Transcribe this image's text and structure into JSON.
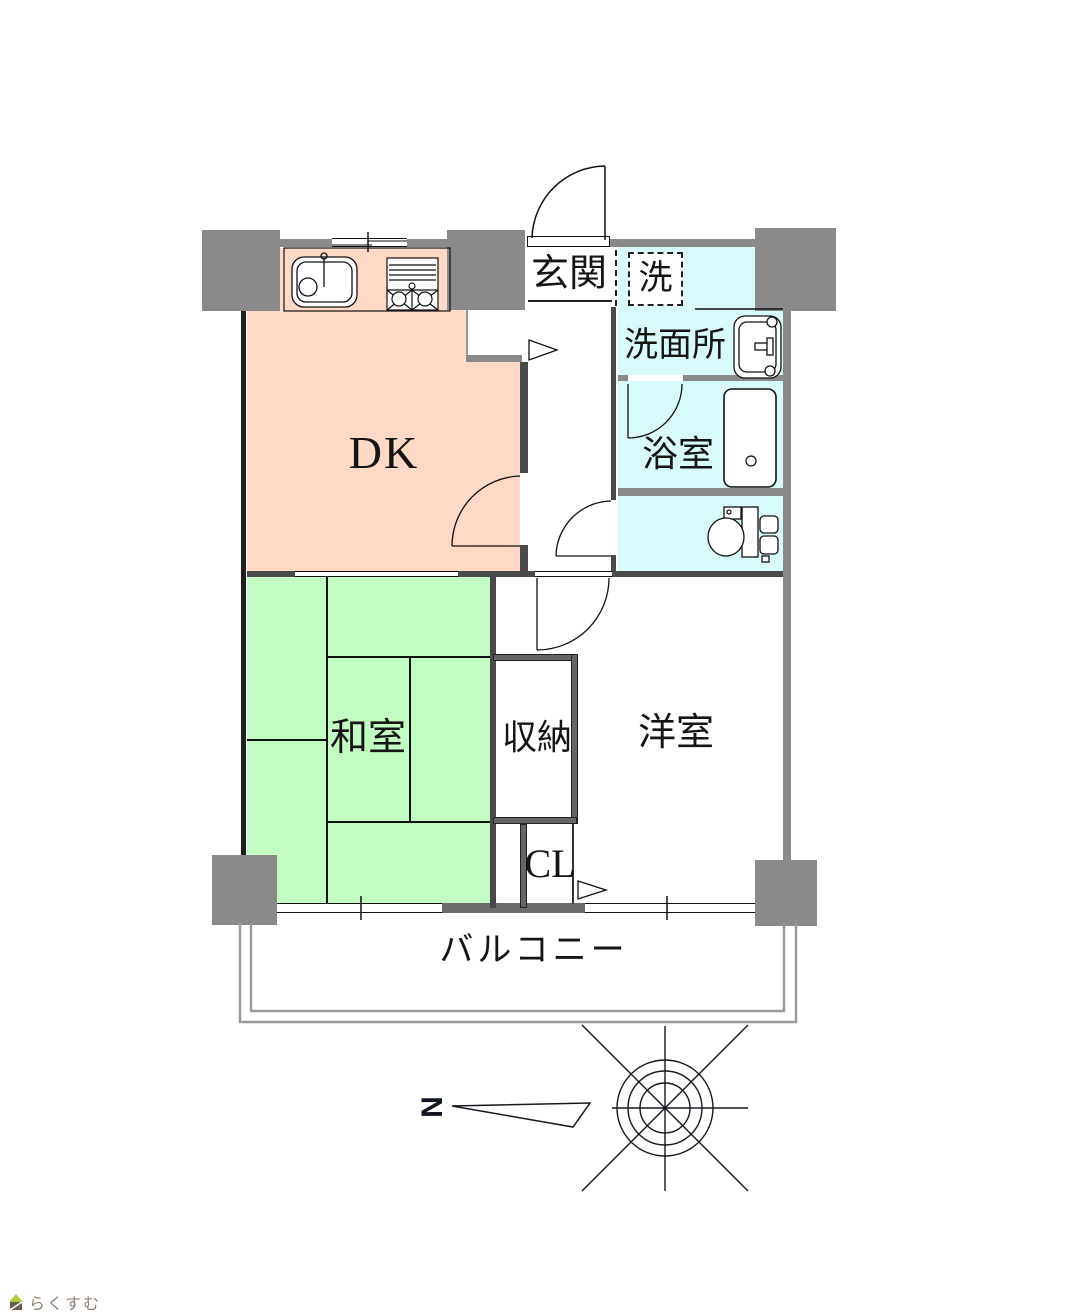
{
  "rooms": {
    "dk": {
      "label": "DK"
    },
    "genkan": {
      "label": "玄関"
    },
    "laundry": {
      "label": "洗"
    },
    "washroom": {
      "label": "洗面所"
    },
    "bathroom": {
      "label": "浴室"
    },
    "japanese_room": {
      "label": "和室"
    },
    "storage": {
      "label": "収納"
    },
    "western_room": {
      "label": "洋室"
    },
    "closet": {
      "label": "CL"
    },
    "balcony": {
      "label": "バルコニー"
    }
  },
  "compass": {
    "north_label": "N"
  },
  "watermark": {
    "text": "らくすむ"
  },
  "colors": {
    "dk_fill": "#FFD9C6",
    "japanese_room_fill": "#C2FCC2",
    "wet_area_fill": "#D8FAFA",
    "pillar_gray": "#8A8A8A",
    "interior_wall": "#4A4A4A"
  }
}
